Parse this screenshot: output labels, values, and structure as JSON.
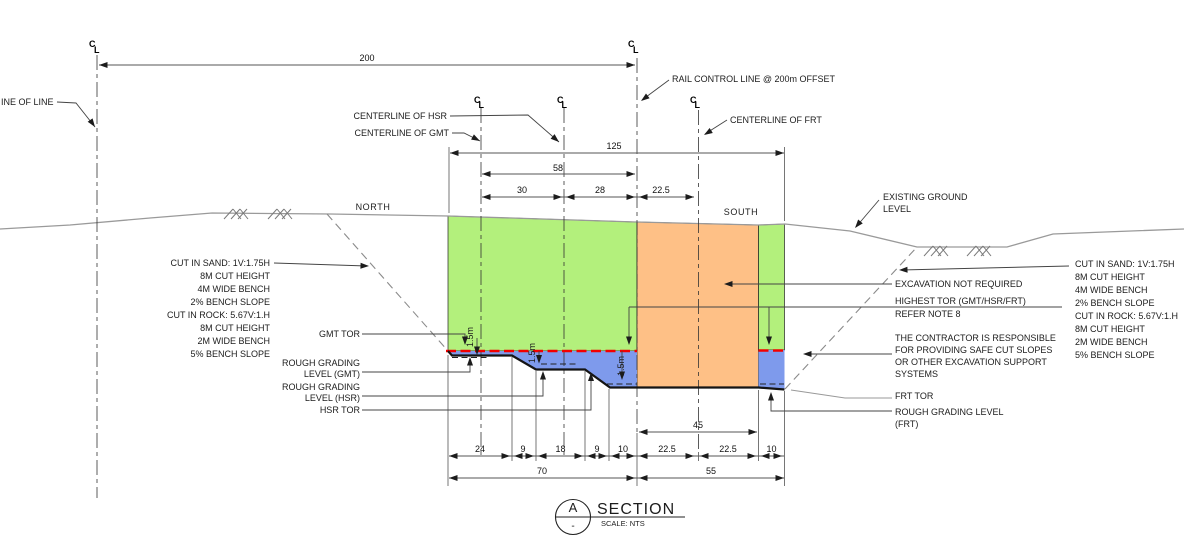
{
  "colors": {
    "sand": "#b3f07c",
    "rock": "#fec086",
    "below_tor": "#7e9aec",
    "tor_line": "#f20000"
  },
  "labels": {
    "line_of_line": "INE OF LINE",
    "centerline_hsr": "CENTERLINE OF HSR",
    "centerline_gmt": "CENTERLINE OF GMT",
    "rail_control_line": "RAIL CONTROL LINE @ 200m OFFSET",
    "centerline_frt": "CENTERLINE OF FRT",
    "existing_ground_1": "EXISTING GROUND",
    "existing_ground_2": "LEVEL",
    "north": "NORTH",
    "south": "SOUTH",
    "gmt_tor": "GMT TOR",
    "rough_grading_gmt_1": "ROUGH GRADING",
    "rough_grading_gmt_2": "LEVEL (GMT)",
    "rough_grading_hsr_1": "ROUGH GRADING",
    "rough_grading_hsr_2": "LEVEL (HSR)",
    "hsr_tor": "HSR TOR",
    "excavation_not_required": "EXCAVATION NOT REQUIRED",
    "highest_tor_1": "HIGHEST TOR (GMT/HSR/FRT)",
    "highest_tor_2": "REFER NOTE 8",
    "contractor_1": "THE CONTRACTOR IS RESPONSIBLE",
    "contractor_2": "FOR PROVIDING SAFE CUT SLOPES",
    "contractor_3": "OR OTHER EXCAVATION SUPPORT",
    "contractor_4": "SYSTEMS",
    "frt_tor": "FRT TOR",
    "rough_grading_frt_1": "ROUGH GRADING LEVEL",
    "rough_grading_frt_2": "(FRT)",
    "depth_1_5m": "1.5m",
    "cl_c": "C",
    "cl_l": "L"
  },
  "notes_left": [
    "CUT IN SAND: 1V:1.75H",
    "8M CUT HEIGHT",
    "4M WIDE BENCH",
    "2% BENCH SLOPE",
    "CUT IN ROCK: 5.67V:1.H",
    "8M CUT HEIGHT",
    "2M WIDE BENCH",
    "5% BENCH SLOPE"
  ],
  "notes_right": [
    "CUT IN SAND: 1V:1.75H",
    "8M CUT HEIGHT",
    "4M WIDE BENCH",
    "2% BENCH SLOPE",
    "CUT IN ROCK: 5.67V:1.H",
    "8M CUT HEIGHT",
    "2M WIDE BENCH",
    "5% BENCH SLOPE"
  ],
  "dimensions": {
    "offset_200": "200",
    "overall_125": "125",
    "span_58": "58",
    "span_30": "30",
    "span_28": "28",
    "span_22_5": "22.5",
    "span_45": "45",
    "row1": [
      "24",
      "9",
      "18",
      "9",
      "10",
      "22.5",
      "22.5",
      "10"
    ],
    "row2": [
      "70",
      "55"
    ]
  },
  "section_marker": {
    "letter": "A",
    "sheet": "-",
    "title": "SECTION",
    "scale": "SCALE: NTS"
  }
}
